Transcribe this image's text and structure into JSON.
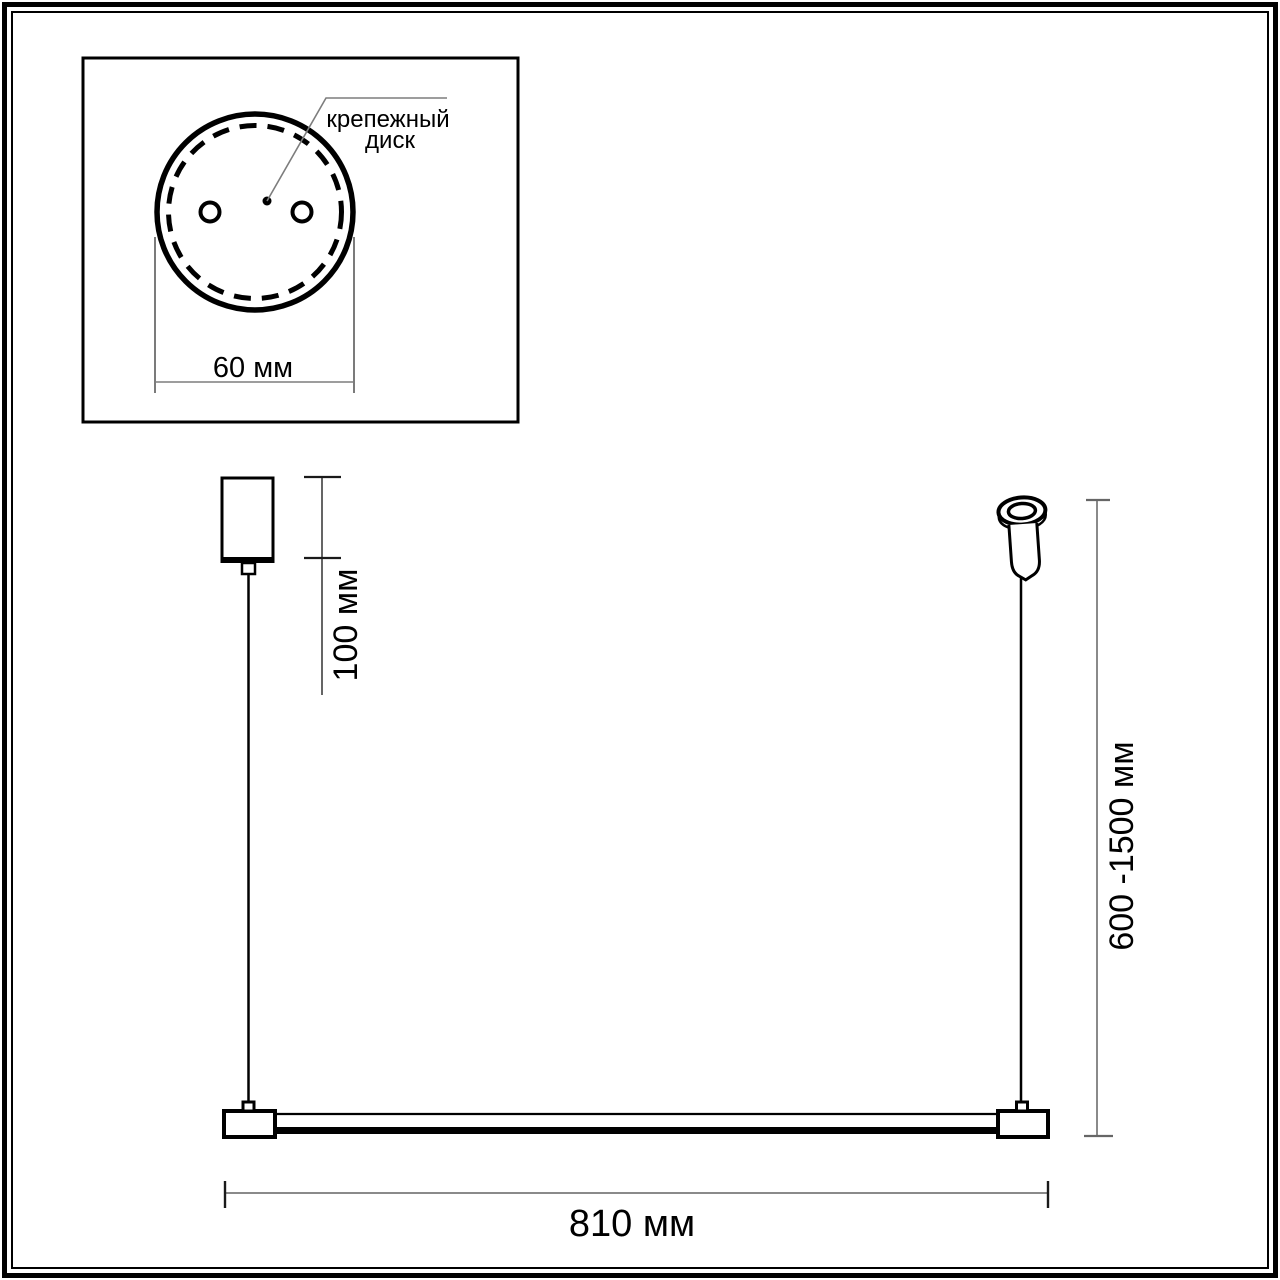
{
  "inset": {
    "callout": {
      "line1": "крепежный",
      "line2": "диск"
    },
    "diameter_label": "60 мм"
  },
  "main": {
    "canopy_height_label": "100 мм",
    "suspension_range_label": "600 -1500 мм",
    "bar_length_label": "810 мм"
  },
  "colors": {
    "ink": "#000000",
    "dimension_line": "#7d7d7d",
    "background": "#ffffff"
  }
}
